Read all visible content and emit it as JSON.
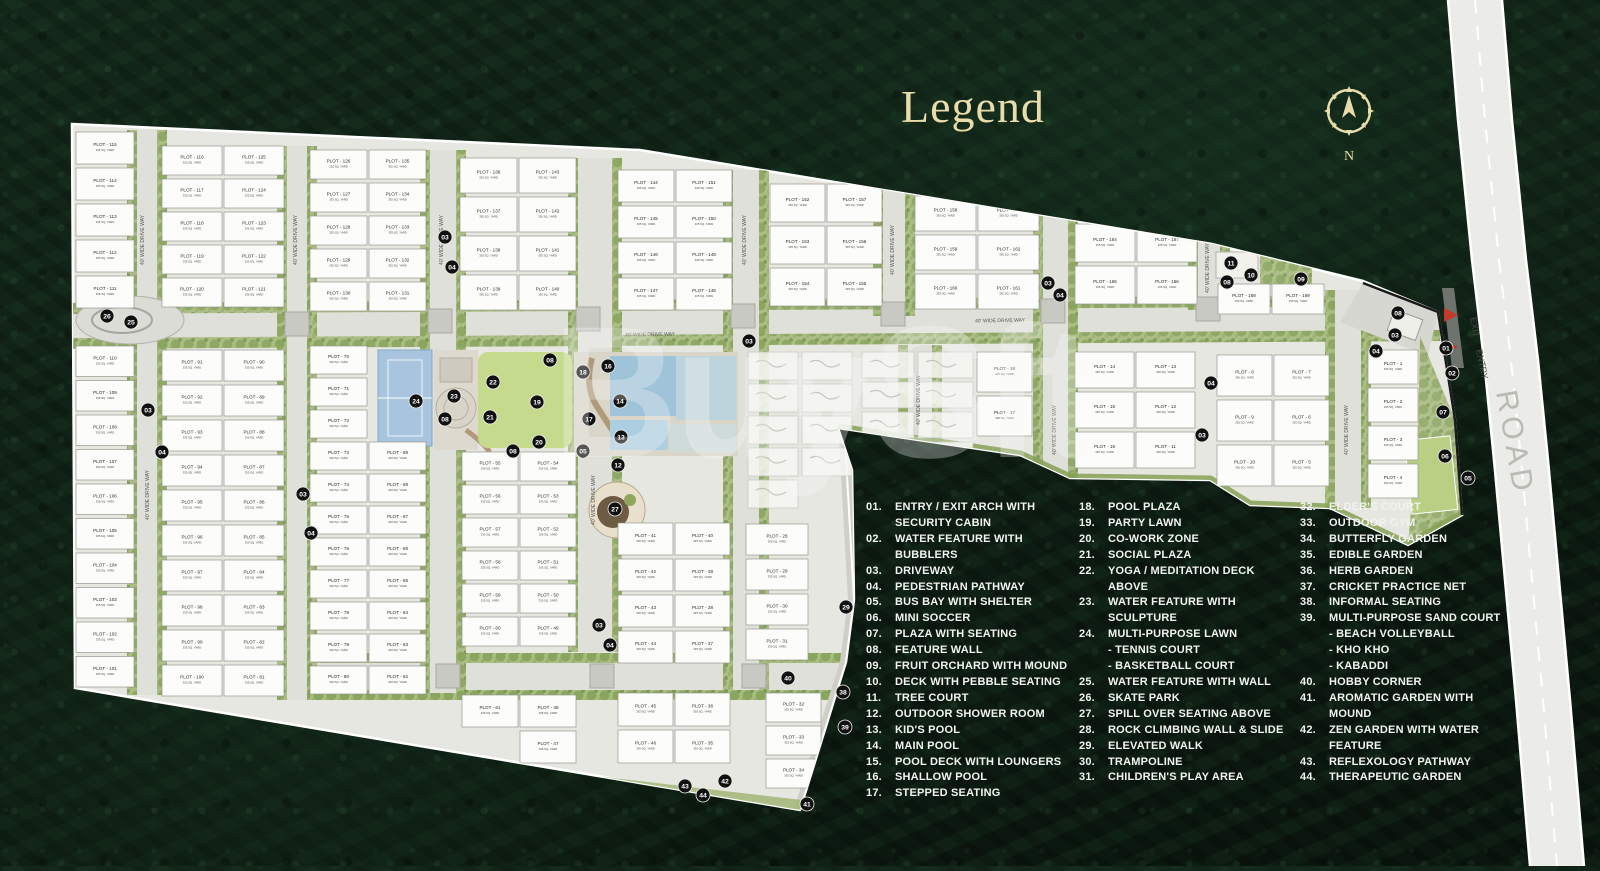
{
  "title": "Legend",
  "compass": {
    "label": "N"
  },
  "watermark": "BuySft",
  "colors": {
    "accent_gold": "#e9dcab",
    "legend_text": "#f1f3f0",
    "ground": "#e7e7e1",
    "plot_fill": "#fcfcfa",
    "tree_green": "#8aa55e",
    "lawn_green": "#c6da8e",
    "pool_blue": "#9fc3d8",
    "road_gray": "#ebebe7",
    "marker_bg": "#101010",
    "arrow_red": "#c23b2a"
  },
  "road": {
    "label": "ROAD",
    "entry_label": "ENTRY",
    "exit_label": "EXIT"
  },
  "site": {
    "driveway_label": "40' WIDE DRIVE WAY",
    "plot_label_prefix": "PLOT",
    "default_area_label": "335 SQ. YARD",
    "blocks": [
      {
        "x": 76,
        "y": 132,
        "w": 58,
        "rh": 36,
        "cols": [
          [
            115,
            114,
            113,
            112,
            111
          ]
        ]
      },
      {
        "x": 162,
        "y": 146,
        "w": 60,
        "rh": 33,
        "cols": [
          [
            116,
            117,
            118,
            119,
            120
          ],
          [
            125,
            124,
            123,
            122,
            121
          ]
        ]
      },
      {
        "x": 310,
        "y": 150,
        "w": 57,
        "rh": 33,
        "cols": [
          [
            126,
            127,
            128,
            129,
            130
          ],
          [
            135,
            134,
            133,
            132,
            131
          ]
        ]
      },
      {
        "x": 460,
        "y": 158,
        "w": 57,
        "rh": 39,
        "cols": [
          [
            136,
            137,
            138,
            139
          ],
          [
            143,
            142,
            141,
            140
          ]
        ]
      },
      {
        "x": 618,
        "y": 170,
        "w": 56,
        "rh": 36,
        "cols": [
          [
            144,
            145,
            146,
            147
          ],
          [
            151,
            150,
            149,
            148
          ]
        ]
      },
      {
        "x": 770,
        "y": 184,
        "w": 55,
        "rh": 42,
        "cols": [
          [
            152,
            153,
            154
          ],
          [
            157,
            156,
            155
          ]
        ]
      },
      {
        "x": 915,
        "y": 196,
        "w": 61,
        "rh": 39,
        "cols": [
          [
            158,
            159,
            160
          ],
          [
            163,
            162,
            161
          ]
        ]
      },
      {
        "x": 1075,
        "y": 224,
        "w": 60,
        "rh": 42,
        "cols": [
          [
            164,
            165
          ],
          [
            167,
            166
          ]
        ]
      },
      {
        "x": 1218,
        "y": 284,
        "w": 52,
        "rh": 34,
        "cols": [
          [
            168
          ],
          [
            169
          ]
        ]
      },
      {
        "x": 76,
        "y": 346,
        "w": 58,
        "rh": 34.5,
        "cols": [
          [
            110,
            109,
            108,
            107,
            106,
            105,
            104,
            103,
            102,
            101
          ]
        ]
      },
      {
        "x": 162,
        "y": 350,
        "w": 60,
        "rh": 35,
        "cols": [
          [
            91,
            92,
            93,
            94,
            95,
            96,
            97,
            98,
            99,
            100
          ],
          [
            90,
            89,
            88,
            87,
            86,
            85,
            84,
            83,
            82,
            81
          ]
        ]
      },
      {
        "x": 310,
        "y": 346,
        "w": 57,
        "rh": 32,
        "cols": [
          [
            70,
            71,
            72,
            73,
            74,
            75,
            76,
            77,
            78,
            79,
            80
          ]
        ]
      },
      {
        "x": 369,
        "y": 442,
        "w": 57,
        "rh": 32,
        "cols": [
          [
            69,
            68,
            67,
            66,
            65,
            64,
            63,
            62
          ]
        ]
      },
      {
        "x": 462,
        "y": 452,
        "w": 56,
        "rh": 33,
        "cols": [
          [
            55,
            56,
            57,
            58,
            59,
            60
          ],
          [
            54,
            53,
            52,
            51,
            50,
            49
          ]
        ]
      },
      {
        "x": 618,
        "y": 523,
        "w": 55,
        "rh": 36,
        "cols": [
          [
            41,
            42,
            43,
            44
          ],
          [
            40,
            39,
            38,
            37
          ]
        ]
      },
      {
        "x": 746,
        "y": 524,
        "w": 62,
        "rh": 35,
        "cols": [
          [
            28,
            29,
            30,
            31
          ]
        ]
      },
      {
        "x": 977,
        "y": 352,
        "w": 55,
        "rh": 44,
        "cols": [
          [
            18,
            17
          ]
        ]
      },
      {
        "x": 1075,
        "y": 352,
        "w": 59,
        "rh": 40,
        "cols": [
          [
            14,
            15,
            16
          ],
          [
            13,
            12,
            11
          ]
        ]
      },
      {
        "x": 1217,
        "y": 355,
        "w": 55,
        "rh": 45,
        "cols": [
          [
            8,
            9,
            10
          ],
          [
            7,
            6,
            5
          ]
        ]
      },
      {
        "x": 1368,
        "y": 350,
        "w": 50,
        "rh": 38,
        "cols": [
          [
            1,
            2,
            3,
            4
          ]
        ]
      },
      {
        "x": 462,
        "y": 695,
        "w": 56,
        "rh": 36,
        "cols": [
          [
            61
          ],
          [
            48,
            47
          ]
        ]
      },
      {
        "x": 618,
        "y": 693,
        "w": 55,
        "rh": 37,
        "cols": [
          [
            45,
            46
          ],
          [
            36,
            35
          ]
        ]
      },
      {
        "x": 766,
        "y": 693,
        "w": 55,
        "rh": 33,
        "cols": [
          [
            32,
            33,
            34
          ]
        ]
      }
    ],
    "markers": [
      [
        "26",
        107,
        316
      ],
      [
        "25",
        131,
        322
      ],
      [
        "03",
        148,
        410
      ],
      [
        "04",
        162,
        452
      ],
      [
        "03",
        303,
        494
      ],
      [
        "04",
        311,
        533
      ],
      [
        "03",
        445,
        237
      ],
      [
        "04",
        452,
        267
      ],
      [
        "03",
        599,
        625
      ],
      [
        "04",
        610,
        645
      ],
      [
        "03",
        749,
        341
      ],
      [
        "08",
        550,
        360
      ],
      [
        "16",
        608,
        366
      ],
      [
        "18",
        583,
        372
      ],
      [
        "22",
        493,
        382
      ],
      [
        "23",
        454,
        396
      ],
      [
        "24",
        416,
        401
      ],
      [
        "14",
        620,
        401
      ],
      [
        "19",
        537,
        402
      ],
      [
        "21",
        490,
        417
      ],
      [
        "08",
        445,
        419
      ],
      [
        "17",
        589,
        419
      ],
      [
        "13",
        621,
        437
      ],
      [
        "20",
        539,
        442
      ],
      [
        "05",
        583,
        451
      ],
      [
        "08",
        513,
        451
      ],
      [
        "12",
        618,
        465
      ],
      [
        "27",
        615,
        509
      ],
      [
        "03",
        1048,
        283
      ],
      [
        "04",
        1060,
        295
      ],
      [
        "11",
        1231,
        263
      ],
      [
        "10",
        1251,
        275
      ],
      [
        "08",
        1227,
        282
      ],
      [
        "09",
        1301,
        279
      ],
      [
        "04",
        1211,
        383
      ],
      [
        "03",
        1202,
        435
      ],
      [
        "08",
        1398,
        313
      ],
      [
        "03",
        1395,
        335
      ],
      [
        "04",
        1376,
        351
      ],
      [
        "01",
        1446,
        348
      ],
      [
        "02",
        1452,
        373
      ],
      [
        "07",
        1443,
        412
      ],
      [
        "06",
        1445,
        456
      ],
      [
        "05",
        1468,
        478
      ],
      [
        "29",
        846,
        607
      ],
      [
        "40",
        788,
        678
      ],
      [
        "38",
        843,
        692
      ],
      [
        "39",
        845,
        727
      ],
      [
        "42",
        725,
        781
      ],
      [
        "43",
        685,
        786
      ],
      [
        "44",
        703,
        795
      ],
      [
        "41",
        807,
        804
      ]
    ]
  },
  "legend": {
    "columns": [
      [
        {
          "n": "01.",
          "t": "ENTRY / EXIT ARCH WITH\nSECURITY CABIN"
        },
        {
          "n": "02.",
          "t": "WATER FEATURE WITH BUBBLERS"
        },
        {
          "n": "03.",
          "t": "DRIVEWAY"
        },
        {
          "n": "04.",
          "t": "PEDESTRIAN PATHWAY"
        },
        {
          "n": "05.",
          "t": "BUS BAY WITH SHELTER"
        },
        {
          "n": "06.",
          "t": "MINI SOCCER"
        },
        {
          "n": "07.",
          "t": "PLAZA WITH SEATING"
        },
        {
          "n": "08.",
          "t": "FEATURE WALL"
        },
        {
          "n": "09.",
          "t": "FRUIT ORCHARD WITH MOUND"
        },
        {
          "n": "10.",
          "t": "DECK WITH PEBBLE SEATING"
        },
        {
          "n": "11.",
          "t": "TREE COURT"
        },
        {
          "n": "12.",
          "t": "OUTDOOR SHOWER ROOM"
        },
        {
          "n": "13.",
          "t": "KID'S POOL"
        },
        {
          "n": "14.",
          "t": "MAIN POOL"
        },
        {
          "n": "15.",
          "t": "POOL DECK WITH LOUNGERS"
        },
        {
          "n": "16.",
          "t": "SHALLOW POOL"
        },
        {
          "n": "17.",
          "t": "STEPPED SEATING"
        }
      ],
      [
        {
          "n": "18.",
          "t": "POOL PLAZA"
        },
        {
          "n": "19.",
          "t": "PARTY LAWN"
        },
        {
          "n": "20.",
          "t": "CO-WORK ZONE"
        },
        {
          "n": "21.",
          "t": "SOCIAL PLAZA"
        },
        {
          "n": "22.",
          "t": "YOGA / MEDITATION DECK\nABOVE"
        },
        {
          "n": "23.",
          "t": "WATER FEATURE WITH\nSCULPTURE"
        },
        {
          "n": "24.",
          "t": "MULTI-PURPOSE LAWN\n- TENNIS COURT\n- BASKETBALL COURT"
        },
        {
          "n": "25.",
          "t": "WATER FEATURE WITH WALL"
        },
        {
          "n": "26.",
          "t": "SKATE PARK"
        },
        {
          "n": "27.",
          "t": "SPILL OVER SEATING ABOVE"
        },
        {
          "n": "28.",
          "t": "ROCK CLIMBING WALL & SLIDE"
        },
        {
          "n": "29.",
          "t": "ELEVATED WALK"
        },
        {
          "n": "30.",
          "t": "TRAMPOLINE"
        },
        {
          "n": "31.",
          "t": "CHILDREN'S PLAY AREA"
        }
      ],
      [
        {
          "n": "32.",
          "t": "ELDER'S COURT"
        },
        {
          "n": "33.",
          "t": "OUTDOOR GYM"
        },
        {
          "n": "34.",
          "t": "BUTTERFLY GARDEN"
        },
        {
          "n": "35.",
          "t": "EDIBLE GARDEN"
        },
        {
          "n": "36.",
          "t": "HERB GARDEN"
        },
        {
          "n": "37.",
          "t": "CRICKET PRACTICE NET"
        },
        {
          "n": "38.",
          "t": "INFORMAL SEATING"
        },
        {
          "n": "39.",
          "t": "MULTI-PURPOSE SAND COURT\n- BEACH VOLLEYBALL\n- KHO KHO\n- KABADDI"
        },
        {
          "n": "40.",
          "t": "HOBBY CORNER"
        },
        {
          "n": "41.",
          "t": "AROMATIC GARDEN WITH\nMOUND"
        },
        {
          "n": "42.",
          "t": "ZEN GARDEN WITH WATER\nFEATURE"
        },
        {
          "n": "43.",
          "t": "REFLEXOLOGY PATHWAY"
        },
        {
          "n": "44.",
          "t": "THERAPEUTIC GARDEN"
        }
      ]
    ]
  }
}
